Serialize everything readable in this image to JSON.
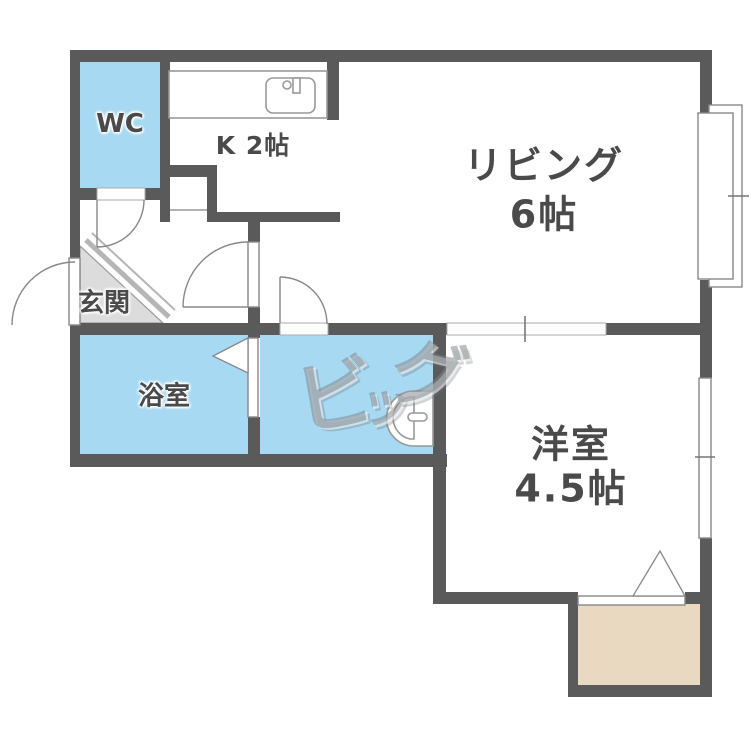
{
  "plan_title": "1DK floor plan",
  "rooms": {
    "wc": {
      "label": "WC"
    },
    "kitchen": {
      "label": "K 2帖"
    },
    "living": {
      "label": "リビング",
      "size": "6帖"
    },
    "entrance": {
      "label": "玄関"
    },
    "bathroom": {
      "label": "浴室"
    },
    "western_room": {
      "label": "洋室",
      "size": "4.5帖"
    }
  },
  "watermark": {
    "text": "ビッグ",
    "chars": [
      "ビ",
      "ッ",
      "グ"
    ]
  },
  "colors": {
    "wall": "#5a5a5a",
    "water_blue": "#a7d9f2",
    "closet_beige": "#e8d9c0",
    "entrance_gray": "#dcdcdc",
    "label_text": "#4a4a4a"
  },
  "icons": {
    "toilet": "toilet-icon",
    "kitchen_sink": "kitchen-sink-icon",
    "doors": [
      "wc-door-arc",
      "entry-door-arc",
      "hall-door-arc",
      "washroom-door-arc",
      "bath-folding-door"
    ],
    "windows": [
      "living-window",
      "western-room-window"
    ],
    "closet_marker": "closet-triangle-marker"
  }
}
